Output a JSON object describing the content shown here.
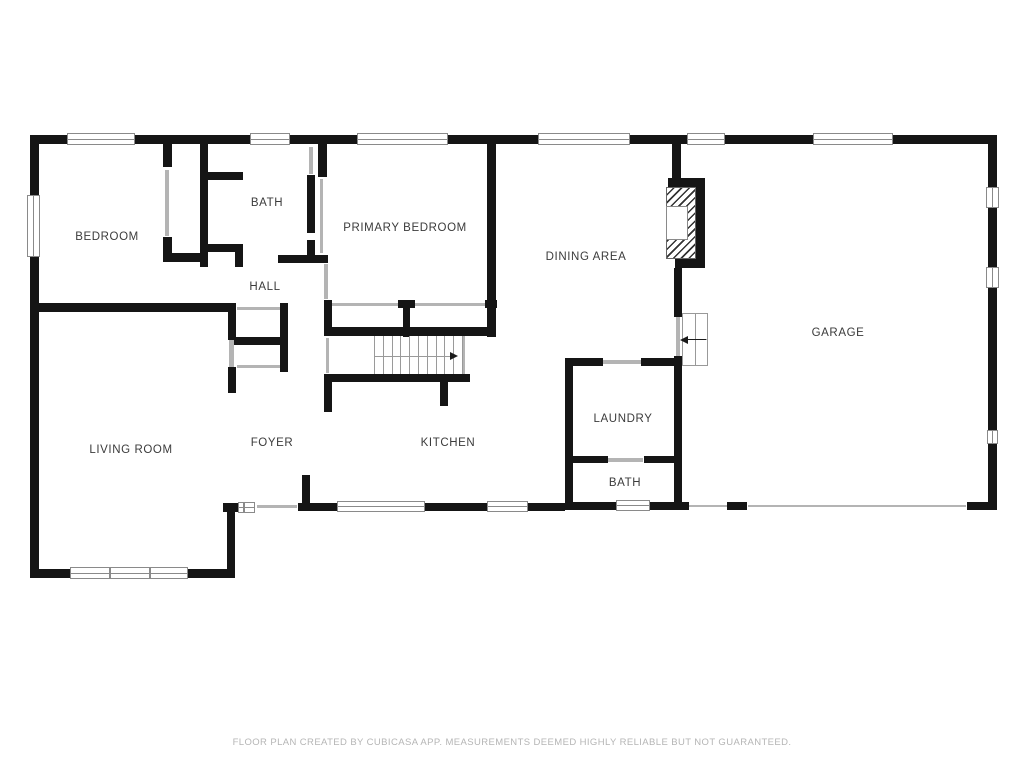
{
  "disclaimer": "FLOOR PLAN CREATED BY CUBICASA APP. MEASUREMENTS DEEMED HIGHLY RELIABLE BUT NOT GUARANTEED.",
  "colors": {
    "wall": "#151515",
    "opening": "#b4b4b4",
    "window_frame": "#8a8a8a",
    "hatch_line": "#333333",
    "label_text": "#3b3b3b",
    "disclaimer_text": "#b5b5b5",
    "arrow": "#1a1a1a"
  },
  "rooms": [
    {
      "id": "bedroom",
      "label": "BEDROOM",
      "x": 107,
      "y": 237
    },
    {
      "id": "bath-upper",
      "label": "BATH",
      "x": 267,
      "y": 203
    },
    {
      "id": "primary-bedroom",
      "label": "PRIMARY BEDROOM",
      "x": 405,
      "y": 228
    },
    {
      "id": "hall",
      "label": "HALL",
      "x": 265,
      "y": 287
    },
    {
      "id": "dining-area",
      "label": "DINING AREA",
      "x": 586,
      "y": 257
    },
    {
      "id": "garage",
      "label": "GARAGE",
      "x": 838,
      "y": 333
    },
    {
      "id": "living-room",
      "label": "LIVING ROOM",
      "x": 131,
      "y": 450
    },
    {
      "id": "foyer",
      "label": "FOYER",
      "x": 272,
      "y": 443
    },
    {
      "id": "kitchen",
      "label": "KITCHEN",
      "x": 448,
      "y": 443
    },
    {
      "id": "laundry",
      "label": "LAUNDRY",
      "x": 623,
      "y": 419
    },
    {
      "id": "bath-lower",
      "label": "BATH",
      "x": 625,
      "y": 483
    }
  ],
  "plan": {
    "walls": [
      [
        30,
        135,
        37,
        9
      ],
      [
        135,
        135,
        115,
        9
      ],
      [
        290,
        135,
        67,
        9
      ],
      [
        448,
        135,
        90,
        9
      ],
      [
        630,
        135,
        57,
        9
      ],
      [
        725,
        135,
        88,
        9
      ],
      [
        893,
        135,
        104,
        9
      ],
      [
        30,
        135,
        9,
        60
      ],
      [
        30,
        257,
        9,
        321
      ],
      [
        988,
        135,
        9,
        52
      ],
      [
        988,
        208,
        9,
        59
      ],
      [
        988,
        288,
        9,
        142
      ],
      [
        988,
        443,
        9,
        67
      ],
      [
        967,
        502,
        30,
        8
      ],
      [
        727,
        502,
        20,
        8
      ],
      [
        680,
        502,
        9,
        8
      ],
      [
        223,
        503,
        15,
        9
      ],
      [
        298,
        503,
        39,
        8
      ],
      [
        425,
        503,
        62,
        8
      ],
      [
        528,
        503,
        37,
        8
      ],
      [
        565,
        502,
        52,
        8
      ],
      [
        650,
        502,
        30,
        8
      ],
      [
        30,
        569,
        40,
        9
      ],
      [
        188,
        569,
        47,
        9
      ],
      [
        227,
        503,
        8,
        75
      ],
      [
        30,
        303,
        198,
        9
      ],
      [
        163,
        143,
        9,
        24
      ],
      [
        163,
        237,
        9,
        25
      ],
      [
        163,
        253,
        42,
        9
      ],
      [
        200,
        143,
        8,
        124
      ],
      [
        205,
        172,
        38,
        8
      ],
      [
        205,
        244,
        38,
        8
      ],
      [
        235,
        244,
        8,
        23
      ],
      [
        307,
        175,
        8,
        58
      ],
      [
        307,
        240,
        8,
        23
      ],
      [
        278,
        255,
        50,
        8
      ],
      [
        318,
        143,
        9,
        34
      ],
      [
        487,
        143,
        9,
        194
      ],
      [
        398,
        300,
        17,
        8
      ],
      [
        485,
        300,
        12,
        8
      ],
      [
        403,
        308,
        7,
        29
      ],
      [
        324,
        300,
        8,
        35
      ],
      [
        324,
        327,
        163,
        9
      ],
      [
        330,
        374,
        140,
        8
      ],
      [
        440,
        382,
        8,
        24
      ],
      [
        324,
        374,
        8,
        38
      ],
      [
        302,
        475,
        8,
        30
      ],
      [
        228,
        303,
        8,
        37
      ],
      [
        228,
        367,
        8,
        26
      ],
      [
        234,
        337,
        54,
        8
      ],
      [
        280,
        303,
        8,
        69
      ],
      [
        672,
        143,
        9,
        35
      ],
      [
        668,
        178,
        37,
        9
      ],
      [
        696,
        178,
        9,
        90
      ],
      [
        675,
        259,
        30,
        9
      ],
      [
        674,
        268,
        8,
        49
      ],
      [
        674,
        356,
        8,
        154
      ],
      [
        565,
        358,
        38,
        8
      ],
      [
        641,
        358,
        34,
        8
      ],
      [
        565,
        358,
        8,
        149
      ],
      [
        565,
        456,
        43,
        7
      ],
      [
        644,
        456,
        31,
        7
      ]
    ],
    "openings": [
      [
        165,
        170,
        4,
        66
      ],
      [
        309,
        147,
        4,
        27
      ],
      [
        320,
        179,
        3,
        74
      ],
      [
        324,
        264,
        4,
        35
      ],
      [
        331,
        303,
        67,
        3
      ],
      [
        415,
        303,
        70,
        3
      ],
      [
        237,
        307,
        43,
        3
      ],
      [
        237,
        365,
        43,
        3
      ],
      [
        229,
        340,
        5,
        27
      ],
      [
        326,
        338,
        3,
        35
      ],
      [
        463,
        336,
        2,
        38
      ],
      [
        257,
        505,
        40,
        3
      ],
      [
        689,
        505,
        38,
        2
      ],
      [
        748,
        505,
        218,
        2
      ],
      [
        676,
        317,
        4,
        39
      ],
      [
        602,
        360,
        39,
        4
      ],
      [
        607,
        458,
        36,
        4
      ]
    ],
    "windows": [
      {
        "x": 67,
        "y": 133,
        "w": 68,
        "h": 12,
        "dir": "h",
        "mullions": []
      },
      {
        "x": 250,
        "y": 133,
        "w": 40,
        "h": 12,
        "dir": "h",
        "mullions": []
      },
      {
        "x": 357,
        "y": 133,
        "w": 91,
        "h": 12,
        "dir": "h",
        "mullions": []
      },
      {
        "x": 538,
        "y": 133,
        "w": 92,
        "h": 12,
        "dir": "h",
        "mullions": []
      },
      {
        "x": 687,
        "y": 133,
        "w": 38,
        "h": 12,
        "dir": "h",
        "mullions": []
      },
      {
        "x": 813,
        "y": 133,
        "w": 80,
        "h": 12,
        "dir": "h",
        "mullions": []
      },
      {
        "x": 27,
        "y": 195,
        "w": 13,
        "h": 62,
        "dir": "v",
        "mullions": []
      },
      {
        "x": 986,
        "y": 187,
        "w": 13,
        "h": 21,
        "dir": "v",
        "mullions": []
      },
      {
        "x": 986,
        "y": 267,
        "w": 13,
        "h": 21,
        "dir": "v",
        "mullions": []
      },
      {
        "x": 987,
        "y": 430,
        "w": 11,
        "h": 14,
        "dir": "v",
        "mullions": []
      },
      {
        "x": 337,
        "y": 501,
        "w": 88,
        "h": 11,
        "dir": "h",
        "mullions": []
      },
      {
        "x": 487,
        "y": 501,
        "w": 41,
        "h": 11,
        "dir": "h",
        "mullions": []
      },
      {
        "x": 616,
        "y": 500,
        "w": 34,
        "h": 11,
        "dir": "h",
        "mullions": []
      },
      {
        "x": 238,
        "y": 502,
        "w": 17,
        "h": 11,
        "dir": "h",
        "mullions": [
          4
        ]
      },
      {
        "x": 70,
        "y": 567,
        "w": 118,
        "h": 12,
        "dir": "h",
        "mullions": [
          38,
          78
        ]
      }
    ],
    "stairs": {
      "x": 374,
      "y": 336,
      "w": 88,
      "h": 38,
      "steps": 10,
      "rail_y": 356,
      "arrow_x1": 374,
      "arrow_x2": 450
    },
    "fireplace": {
      "hatch": {
        "x": 666,
        "y": 187,
        "w": 30,
        "h": 72
      },
      "firebox": {
        "x": 666,
        "y": 206,
        "w": 22,
        "h": 34
      }
    },
    "garage_steps": {
      "x": 682,
      "y": 313,
      "w": 26,
      "h": 53,
      "vdiv": 13,
      "hdiv": 26,
      "arrow_y": 339,
      "arrow_x1": 706,
      "arrow_x2": 688
    }
  }
}
